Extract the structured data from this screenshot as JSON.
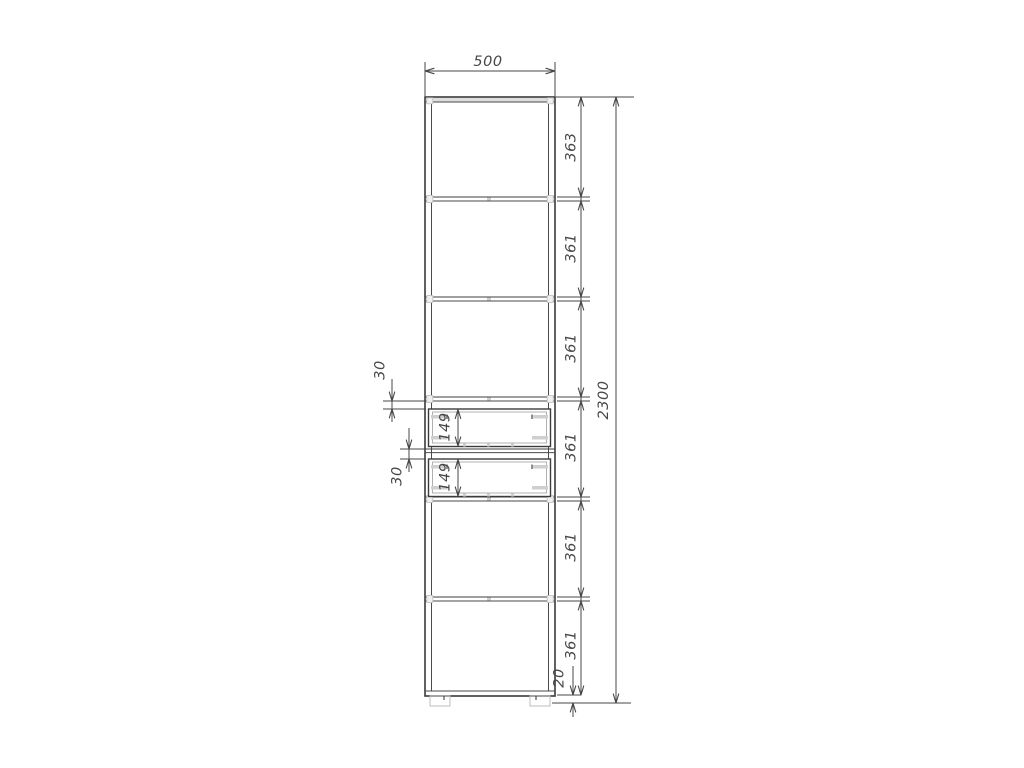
{
  "drawing": {
    "type": "furniture-front-elevation-drawing",
    "background_color": "#ffffff",
    "line_color": "#3f3f3f",
    "light_detail_color": "#bdbdbd",
    "text_color": "#474747"
  },
  "dimensions": {
    "width": {
      "label": "500"
    },
    "total_height": {
      "label": "2300"
    },
    "segments": [
      {
        "label": "363"
      },
      {
        "label": "361"
      },
      {
        "label": "361"
      },
      {
        "label": "361"
      },
      {
        "label": "361"
      },
      {
        "label": "361"
      }
    ],
    "gap_above_top_drawer": {
      "label": "30"
    },
    "gap_above_bottom_drawer": {
      "label": "30"
    },
    "top_drawer_height": {
      "label": "149"
    },
    "bottom_drawer_height": {
      "label": "149"
    },
    "base_height": {
      "label": "20"
    }
  }
}
